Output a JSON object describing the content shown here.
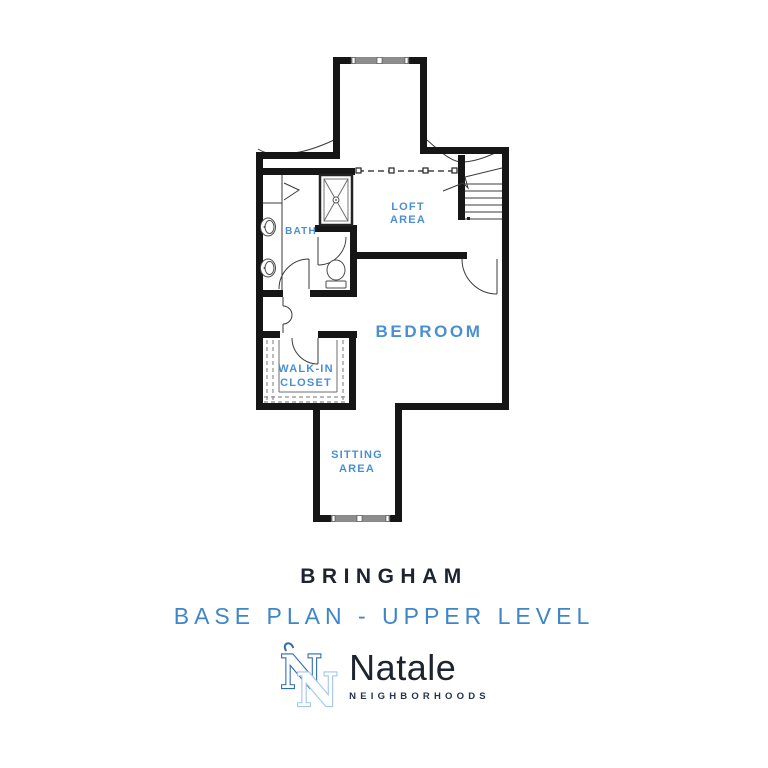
{
  "theme": {
    "label_blue": "#4a8fd0",
    "subtitle_blue": "#3e86c8",
    "title_dark": "#1d2430",
    "wall_black": "#161616",
    "monogram_dark": "#2e6cb2",
    "monogram_light": "#a3c6e8",
    "tagline_navy": "#223350"
  },
  "plan": {
    "rooms": {
      "loft": {
        "line1": "LOFT",
        "line2": "AREA"
      },
      "bath": {
        "label": "BATH"
      },
      "bedroom": {
        "label": "BEDROOM"
      },
      "closet": {
        "line1": "WALK-IN",
        "line2": "CLOSET"
      },
      "sitting": {
        "line1": "SITTING",
        "line2": "AREA"
      }
    }
  },
  "titles": {
    "plan_name": "BRINGHAM",
    "plan_variant": "BASE PLAN - UPPER LEVEL"
  },
  "logo": {
    "monogram_letter": "N",
    "brand": "Natale",
    "tagline": "NEIGHBORHOODS"
  }
}
